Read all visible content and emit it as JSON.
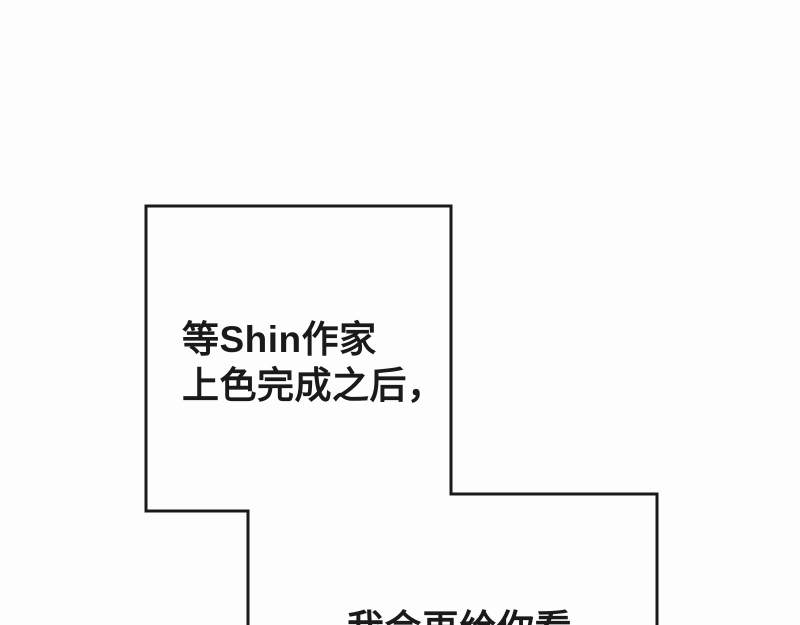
{
  "colors": {
    "background": "#fdfdfd",
    "outline": "#1a1a1a",
    "text": "#1a1a1a"
  },
  "speech_bubble": {
    "line1": "等Shin作家",
    "line2": "上色完成之后，",
    "clipped_next_line": "我会再给你看"
  }
}
